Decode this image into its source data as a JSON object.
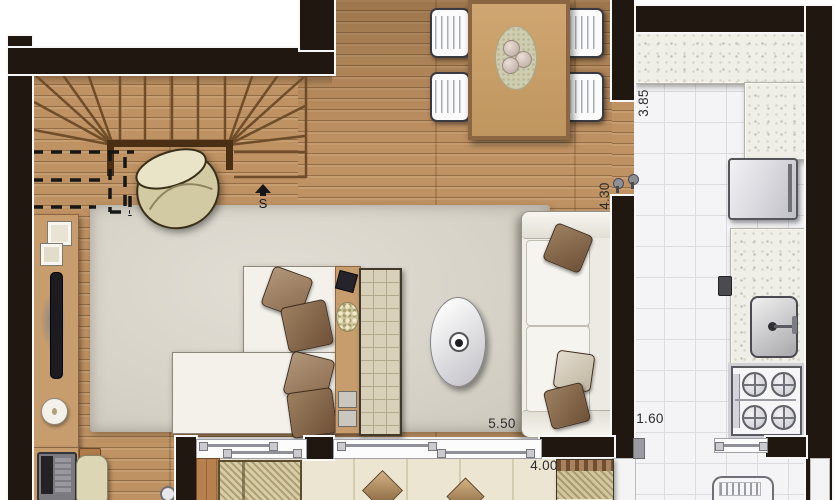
{
  "floor_plan": {
    "stair_marker": "S",
    "dimensions": {
      "kitchen_depth": "3.85",
      "living_depth": "4.30",
      "living_width": "5.50",
      "balcony_width": "4.00",
      "kitchen_width": "1.60"
    },
    "colors": {
      "wall": "#201711",
      "wood_floor": "#bf9263",
      "wood_plank_line": "#9e784c",
      "kitchen_tile": "#f4f4f6",
      "balcony_tile": "#ece5d1",
      "rug": "#d8d4ca",
      "counter_granite": "#efeee7",
      "pillow_brown": "#8f7156",
      "furniture_white": "#f3f1ea"
    },
    "symbols": [
      "staircase",
      "armchair",
      "dining-table",
      "dining-chair",
      "sofa",
      "rug",
      "coffee-table",
      "chaise-longue",
      "tv-console",
      "tufted-bench",
      "sideboard",
      "wall-tv",
      "clock",
      "desk",
      "laptop",
      "desk-chair",
      "kitchen-counter",
      "refrigerator",
      "sink",
      "stove",
      "washing-machine",
      "sliding-door",
      "window",
      "balcony-lounger",
      "balcony-bench",
      "folded-towel"
    ]
  }
}
